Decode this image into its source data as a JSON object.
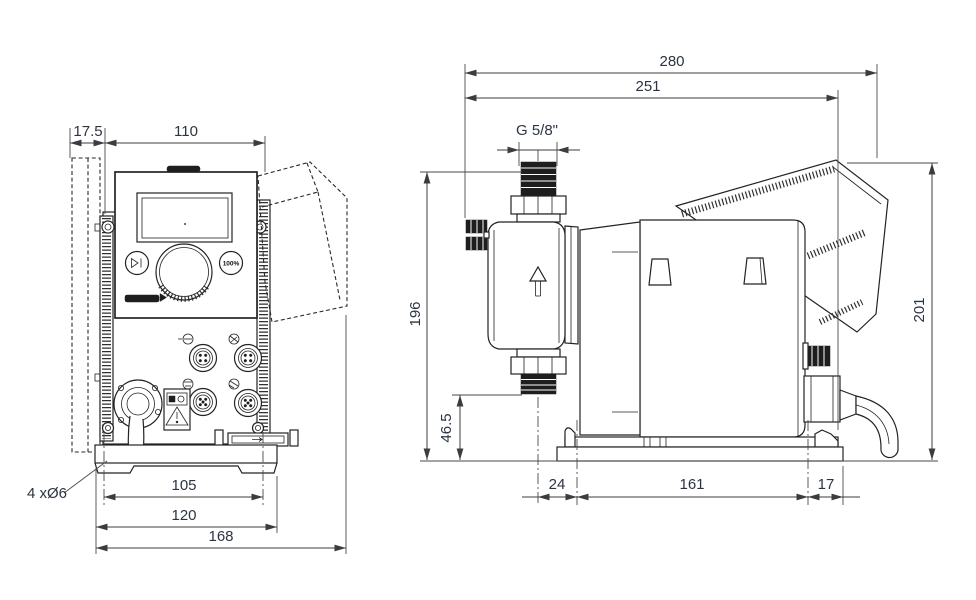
{
  "front_view": {
    "dims": {
      "wall_offset": "17.5",
      "housing_width": "110",
      "hole_pitch": "105",
      "base_width": "120",
      "overall_width": "168",
      "mounting_holes": "4 xØ6"
    },
    "panel": {
      "boost_button": "100%"
    }
  },
  "side_view": {
    "dims": {
      "overall_depth": "280",
      "depth_to_rear": "251",
      "connection_thread": "G 5/8\"",
      "height_to_connection_top": "196",
      "overall_height": "201",
      "suction_connection_height": "46.5",
      "front_hole_to_center": "24",
      "hole_pitch": "161",
      "rear_hole_to_edge": "17"
    }
  },
  "icons": {
    "start_stop_button": "▶|",
    "flow_direction_arrow": "↑",
    "warning_label": "⚠"
  }
}
